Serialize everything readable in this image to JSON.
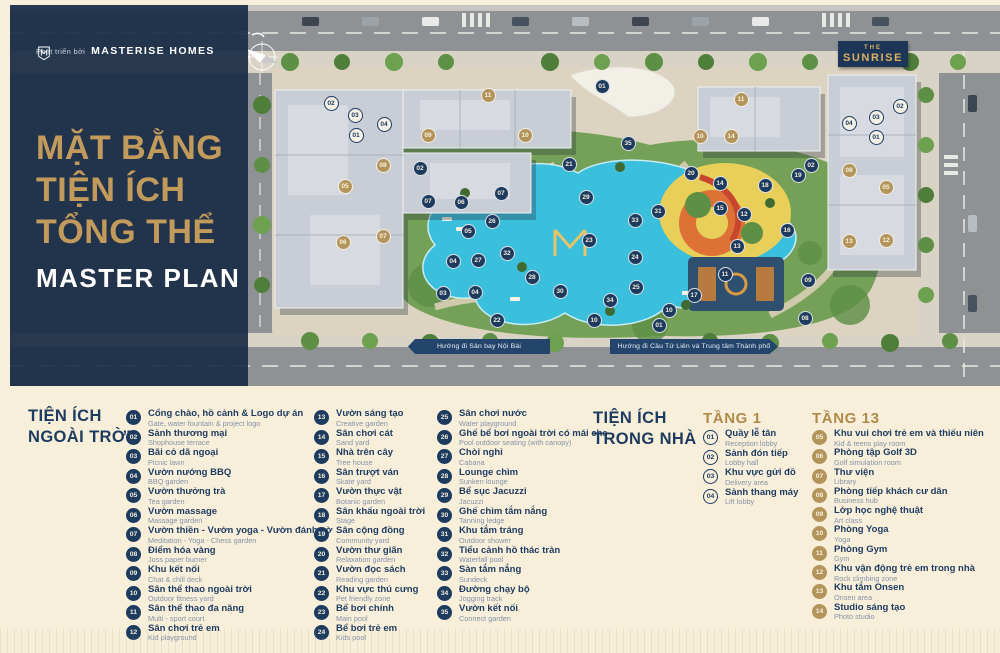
{
  "brand": {
    "developer_prefix": "Phát triển bởi",
    "developer_name": "MASTERISE HOMES",
    "badge": {
      "line1": "THE",
      "line2": "SUNRISE"
    }
  },
  "sidebar": {
    "title_line1": "MẶT BẰNG",
    "title_line2": "TIỆN ÍCH",
    "title_line3": "TỔNG THỂ",
    "subtitle": "MASTER PLAN"
  },
  "map": {
    "compass_label": "B",
    "banner_left": "Hướng đi Sân bay Nội Bài",
    "banner_right": "Hướng đi Cầu Tứ Liên và Trung tâm Thành phố",
    "markers": [
      {
        "n": "02",
        "t": "w",
        "x": 321,
        "y": 98
      },
      {
        "n": "03",
        "t": "w",
        "x": 345,
        "y": 110
      },
      {
        "n": "04",
        "t": "w",
        "x": 374,
        "y": 119
      },
      {
        "n": "01",
        "t": "w",
        "x": 346,
        "y": 130
      },
      {
        "n": "02",
        "t": "w",
        "x": 890,
        "y": 101
      },
      {
        "n": "03",
        "t": "w",
        "x": 866,
        "y": 112
      },
      {
        "n": "04",
        "t": "w",
        "x": 839,
        "y": 118
      },
      {
        "n": "01",
        "t": "w",
        "x": 866,
        "y": 132
      },
      {
        "n": "11",
        "t": "g",
        "x": 478,
        "y": 90
      },
      {
        "n": "09",
        "t": "g",
        "x": 418,
        "y": 130
      },
      {
        "n": "10",
        "t": "g",
        "x": 515,
        "y": 130
      },
      {
        "n": "08",
        "t": "g",
        "x": 373,
        "y": 160
      },
      {
        "n": "05",
        "t": "g",
        "x": 335,
        "y": 181
      },
      {
        "n": "06",
        "t": "g",
        "x": 333,
        "y": 237
      },
      {
        "n": "07",
        "t": "g",
        "x": 373,
        "y": 231
      },
      {
        "n": "11",
        "t": "g",
        "x": 731,
        "y": 94
      },
      {
        "n": "10",
        "t": "g",
        "x": 690,
        "y": 131
      },
      {
        "n": "14",
        "t": "g",
        "x": 721,
        "y": 131
      },
      {
        "n": "08",
        "t": "g",
        "x": 839,
        "y": 165
      },
      {
        "n": "05",
        "t": "g",
        "x": 876,
        "y": 182
      },
      {
        "n": "13",
        "t": "g",
        "x": 839,
        "y": 236
      },
      {
        "n": "12",
        "t": "g",
        "x": 876,
        "y": 235
      },
      {
        "n": "01",
        "t": "o",
        "x": 592,
        "y": 81
      },
      {
        "n": "35",
        "t": "o",
        "x": 618,
        "y": 138
      },
      {
        "n": "21",
        "t": "o",
        "x": 559,
        "y": 159
      },
      {
        "n": "02",
        "t": "o",
        "x": 410,
        "y": 163
      },
      {
        "n": "20",
        "t": "o",
        "x": 681,
        "y": 168
      },
      {
        "n": "02",
        "t": "o",
        "x": 801,
        "y": 160
      },
      {
        "n": "19",
        "t": "o",
        "x": 788,
        "y": 170
      },
      {
        "n": "14",
        "t": "o",
        "x": 710,
        "y": 178
      },
      {
        "n": "18",
        "t": "o",
        "x": 755,
        "y": 180
      },
      {
        "n": "07",
        "t": "o",
        "x": 491,
        "y": 188
      },
      {
        "n": "29",
        "t": "o",
        "x": 576,
        "y": 192
      },
      {
        "n": "07",
        "t": "o",
        "x": 418,
        "y": 196
      },
      {
        "n": "06",
        "t": "o",
        "x": 451,
        "y": 197
      },
      {
        "n": "15",
        "t": "o",
        "x": 710,
        "y": 203
      },
      {
        "n": "31",
        "t": "o",
        "x": 648,
        "y": 206
      },
      {
        "n": "12",
        "t": "o",
        "x": 734,
        "y": 209
      },
      {
        "n": "33",
        "t": "o",
        "x": 625,
        "y": 215
      },
      {
        "n": "26",
        "t": "o",
        "x": 482,
        "y": 216
      },
      {
        "n": "05",
        "t": "o",
        "x": 458,
        "y": 226
      },
      {
        "n": "16",
        "t": "o",
        "x": 777,
        "y": 225
      },
      {
        "n": "23",
        "t": "o",
        "x": 579,
        "y": 235
      },
      {
        "n": "13",
        "t": "o",
        "x": 727,
        "y": 241
      },
      {
        "n": "32",
        "t": "o",
        "x": 497,
        "y": 248
      },
      {
        "n": "24",
        "t": "o",
        "x": 625,
        "y": 252
      },
      {
        "n": "27",
        "t": "o",
        "x": 468,
        "y": 255
      },
      {
        "n": "04",
        "t": "o",
        "x": 443,
        "y": 256
      },
      {
        "n": "11",
        "t": "o",
        "x": 715,
        "y": 269
      },
      {
        "n": "28",
        "t": "o",
        "x": 522,
        "y": 272
      },
      {
        "n": "09",
        "t": "o",
        "x": 798,
        "y": 275
      },
      {
        "n": "25",
        "t": "o",
        "x": 626,
        "y": 282
      },
      {
        "n": "30",
        "t": "o",
        "x": 550,
        "y": 286
      },
      {
        "n": "03",
        "t": "o",
        "x": 433,
        "y": 288
      },
      {
        "n": "04",
        "t": "o",
        "x": 465,
        "y": 287
      },
      {
        "n": "17",
        "t": "o",
        "x": 684,
        "y": 290
      },
      {
        "n": "34",
        "t": "o",
        "x": 600,
        "y": 295
      },
      {
        "n": "10",
        "t": "o",
        "x": 659,
        "y": 305
      },
      {
        "n": "08",
        "t": "o",
        "x": 795,
        "y": 313
      },
      {
        "n": "10",
        "t": "o",
        "x": 584,
        "y": 315
      },
      {
        "n": "22",
        "t": "o",
        "x": 487,
        "y": 315
      },
      {
        "n": "01",
        "t": "o",
        "x": 649,
        "y": 320
      }
    ]
  },
  "legend": {
    "outdoor": {
      "heading_line1": "TIỆN ÍCH",
      "heading_line2": "NGOÀI TRỜI",
      "items": [
        {
          "num": "01",
          "vi": "Cổng chào, hồ cảnh & Logo dự án",
          "en": "Gate, water fountain & project logo"
        },
        {
          "num": "02",
          "vi": "Sảnh thương mại",
          "en": "Shophouse terrace"
        },
        {
          "num": "03",
          "vi": "Bãi cỏ dã ngoại",
          "en": "Picnic lawn"
        },
        {
          "num": "04",
          "vi": "Vườn nướng BBQ",
          "en": "BBQ garden"
        },
        {
          "num": "05",
          "vi": "Vườn thưởng trà",
          "en": "Tea garden"
        },
        {
          "num": "06",
          "vi": "Vườn massage",
          "en": "Massage garden"
        },
        {
          "num": "07",
          "vi": "Vườn thiền - Vườn yoga - Vườn đánh cờ",
          "en": "Meditation - Yoga - Chess garden"
        },
        {
          "num": "08",
          "vi": "Điểm hóa vàng",
          "en": "Joss paper burner"
        },
        {
          "num": "09",
          "vi": "Khu kết nối",
          "en": "Chat & chill deck"
        },
        {
          "num": "10",
          "vi": "Sân thể thao ngoài trời",
          "en": "Outdoor fitness yard"
        },
        {
          "num": "11",
          "vi": "Sân thể thao đa năng",
          "en": "Multi - sport court"
        },
        {
          "num": "12",
          "vi": "Sân chơi trẻ em",
          "en": "Kid playground"
        },
        {
          "num": "13",
          "vi": "Vườn sáng tạo",
          "en": "Creative garden"
        },
        {
          "num": "14",
          "vi": "Sân chơi cát",
          "en": "Sand yard"
        },
        {
          "num": "15",
          "vi": "Nhà trên cây",
          "en": "Tree house"
        },
        {
          "num": "16",
          "vi": "Sân trượt ván",
          "en": "Skate yard"
        },
        {
          "num": "17",
          "vi": "Vườn thực vật",
          "en": "Botanic garden"
        },
        {
          "num": "18",
          "vi": "Sân khấu ngoài trời",
          "en": "Stage"
        },
        {
          "num": "19",
          "vi": "Sân cộng đồng",
          "en": "Community yard"
        },
        {
          "num": "20",
          "vi": "Vườn thư giãn",
          "en": "Relaxation garden"
        },
        {
          "num": "21",
          "vi": "Vườn đọc sách",
          "en": "Reading garden"
        },
        {
          "num": "22",
          "vi": "Khu vực thú cưng",
          "en": "Pet friendly zone"
        },
        {
          "num": "23",
          "vi": "Bể bơi chính",
          "en": "Main pool"
        },
        {
          "num": "24",
          "vi": "Bể bơi trẻ em",
          "en": "Kids pool"
        },
        {
          "num": "25",
          "vi": "Sân chơi nước",
          "en": "Water playground"
        },
        {
          "num": "26",
          "vi": "Ghế bể bơi ngoài trời có mái che",
          "en": "Pool outdoor seating (with canopy)"
        },
        {
          "num": "27",
          "vi": "Chòi nghỉ",
          "en": "Cabana"
        },
        {
          "num": "28",
          "vi": "Lounge chìm",
          "en": "Sunken lounge"
        },
        {
          "num": "29",
          "vi": "Bể sục Jacuzzi",
          "en": "Jacuzzi"
        },
        {
          "num": "30",
          "vi": "Ghế chìm tắm nắng",
          "en": "Tanning ledge"
        },
        {
          "num": "31",
          "vi": "Khu tắm tráng",
          "en": "Outdoor shower"
        },
        {
          "num": "32",
          "vi": "Tiểu cảnh hồ thác tràn",
          "en": "Waterfall pool"
        },
        {
          "num": "33",
          "vi": "Sàn tắm nắng",
          "en": "Sundeck"
        },
        {
          "num": "34",
          "vi": "Đường chạy bộ",
          "en": "Jogging track"
        },
        {
          "num": "35",
          "vi": "Vườn kết nối",
          "en": "Connect garden"
        }
      ]
    },
    "indoor": {
      "heading_line1": "TIỆN ÍCH",
      "heading_line2": "TRONG NHÀ",
      "floors": [
        {
          "label": "TẦNG 1",
          "style": "outline",
          "items": [
            {
              "num": "01",
              "vi": "Quầy lễ tân",
              "en": "Reception lobby"
            },
            {
              "num": "02",
              "vi": "Sảnh đón tiếp",
              "en": "Lobby hall"
            },
            {
              "num": "03",
              "vi": "Khu vực gửi đồ",
              "en": "Delivery area"
            },
            {
              "num": "04",
              "vi": "Sảnh thang máy",
              "en": "Lift lobby"
            }
          ]
        },
        {
          "label": "TẦNG 13",
          "style": "gold",
          "items": [
            {
              "num": "05",
              "vi": "Khu vui chơi trẻ em và thiếu niên",
              "en": "Kid & teens play room"
            },
            {
              "num": "06",
              "vi": "Phòng tập Golf 3D",
              "en": "Golf simulation room"
            },
            {
              "num": "07",
              "vi": "Thư viện",
              "en": "Library"
            },
            {
              "num": "08",
              "vi": "Phòng tiếp khách cư dân",
              "en": "Business hub"
            },
            {
              "num": "09",
              "vi": "Lớp học nghệ thuật",
              "en": "Art class"
            },
            {
              "num": "10",
              "vi": "Phòng Yoga",
              "en": "Yoga"
            },
            {
              "num": "11",
              "vi": "Phòng Gym",
              "en": "Gym"
            },
            {
              "num": "12",
              "vi": "Khu vận động trẻ em trong nhà",
              "en": "Rock climbing zone"
            },
            {
              "num": "13",
              "vi": "Khu tắm Onsen",
              "en": "Onsen area"
            },
            {
              "num": "14",
              "vi": "Studio sáng tạo",
              "en": "Photo studio"
            }
          ]
        }
      ]
    }
  },
  "colors": {
    "navy": "#1d3a5f",
    "gold": "#c29b5c",
    "cream": "#f7efda",
    "marker_gold": "#b3945a",
    "pool": "#3abfdc"
  }
}
